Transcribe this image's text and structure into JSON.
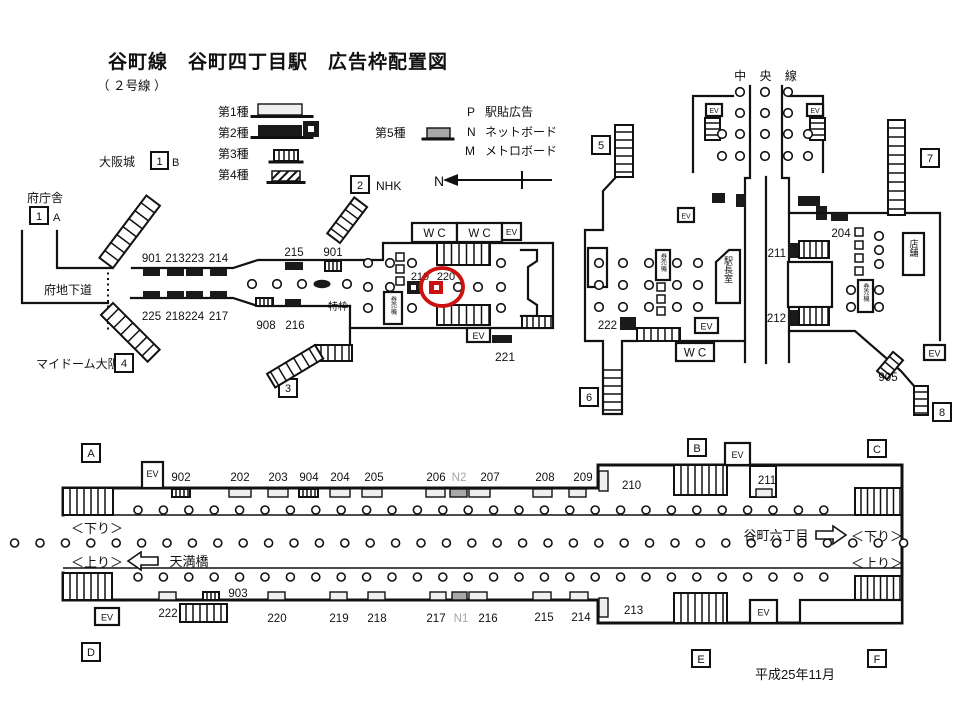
{
  "title": "谷町線　谷町四丁目駅　広告枠配置図",
  "subtitle": "（ ２号線 ）",
  "issued": "平成25年11月",
  "legend": {
    "type1": "第1種",
    "type2": "第2種",
    "type3": "第3種",
    "type4": "第4種",
    "type5": "第5種",
    "p_key": "P",
    "p_label": "駅貼広告",
    "n_key": "N",
    "n_label": "ネットボード",
    "m_key": "M",
    "m_label": "メトロボード",
    "north": "N"
  },
  "exits": {
    "fuchosha": "府庁舎",
    "e1a": "1",
    "e1a_s": "A",
    "osakajo": "大阪城",
    "e1b": "1",
    "e1b_s": "B",
    "fuchika": "府地下道",
    "mydome": "マイドーム大阪",
    "e4": "4",
    "e2": "2",
    "nhk": "NHK",
    "e3": "3",
    "e5": "5",
    "e6": "6",
    "e7": "7",
    "e8": "8"
  },
  "concourse": {
    "ads_top": [
      "901",
      "213",
      "223",
      "214"
    ],
    "ads_bottom": [
      "225",
      "218",
      "224",
      "217"
    ],
    "f215": "215",
    "f901": "901",
    "tokuwaku": "特枠",
    "f908": "908",
    "f216": "216",
    "f219": "219",
    "f220": "220",
    "f221": "221",
    "wc1": "W C",
    "wc2": "W C",
    "ev_top": "EV",
    "ev_bottom": "EV",
    "kenbaiki": "券売機"
  },
  "east": {
    "chuo": "中 央 線",
    "f222": "222",
    "f204": "204",
    "f211": "211",
    "f212": "212",
    "f905": "905",
    "ekicho": "駅長室",
    "tenpo": "店舗",
    "wc": "W C",
    "kenbaiki_w": "券売機",
    "kenbaiki_e": "券売機",
    "ev_nw": "EV",
    "ev_ne": "EV",
    "ev_wu": "EV",
    "ev_w": "EV",
    "ev_se": "EV"
  },
  "platform": {
    "corners": [
      "A",
      "B",
      "C",
      "D",
      "E",
      "F"
    ],
    "ads_top": [
      "902",
      "202",
      "203",
      "904",
      "204",
      "205",
      "206",
      "N2",
      "207",
      "208",
      "209",
      "210",
      "211"
    ],
    "ads_bottom": [
      "222",
      "903",
      "220",
      "219",
      "218",
      "217",
      "N1",
      "216",
      "215",
      "214",
      "213"
    ],
    "ev_a": "EV",
    "ev_b": "EV",
    "ev_d": "EV",
    "ev_e": "EV",
    "down": "＜下り＞",
    "up": "＜上り＞",
    "down_r": "＜下り＞",
    "up_r": "＜上り＞",
    "temmabashi": "天満橋",
    "tanimachi6": "谷町六丁目"
  },
  "colors": {
    "red": "#cc1111",
    "dark": "#1a1a1a",
    "gray_fill": "#a8a8a8",
    "gray_text": "#a6a6a6"
  }
}
